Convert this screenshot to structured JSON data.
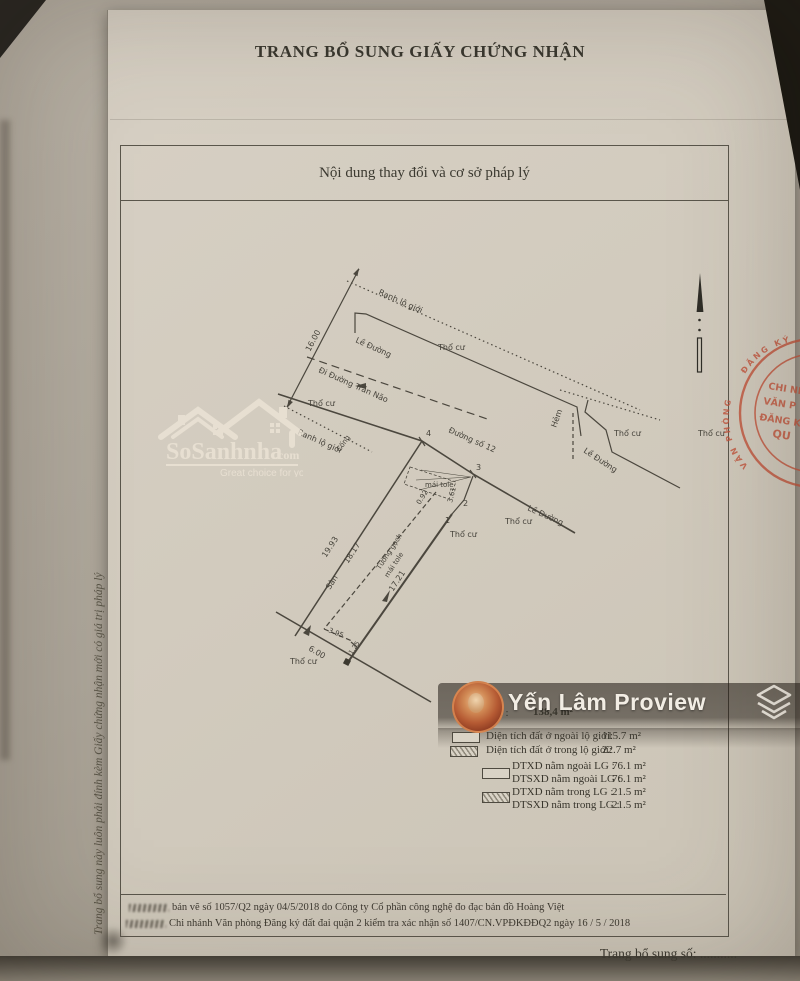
{
  "page": {
    "title": "TRANG BỔ SUNG GIẤY CHỨNG NHẬN",
    "box_header": "Nội dung thay đổi và cơ sở pháp lý",
    "side_note": "Trang bổ sung này luôn phải đính kèm Giấy chứng nhận mới có giá trị pháp lý",
    "footer_label": "Trang bổ sung số: ..........."
  },
  "watermark": {
    "brand": "SoSanhnha",
    "brand_suffix": ".com",
    "tagline": "Great choice for you"
  },
  "overlay": {
    "name": "Yến Lâm Proview"
  },
  "map": {
    "ranh_lo_gioi_1": "Ranh lộ giới",
    "ranh_lo_gioi_2": "Ranh lộ giới",
    "dim_16": "16.00",
    "le_duong_1": "Lề Đường",
    "le_duong_2": "Lề Đường",
    "le_duong_3": "Lề Đường",
    "di_duong_tran_nao": "Đi Đường Trần Não",
    "duong_so_12": "Đường số 12",
    "hem": "Hẻm",
    "cong": "Cống",
    "tho_cu_1": "Thổ cư",
    "tho_cu_2": "Thổ cư",
    "tho_cu_3": "Thổ cư",
    "tho_cu_4": "Thổ cư",
    "tho_cu_5": "Thổ cư",
    "tho_cu_6": "Thổ cư",
    "tho_cu_7": "Thổ cư",
    "mai_tole_shed": "mái tole",
    "tuong_gach_line1": "Tường gạch",
    "tuong_gach_line2": "mái tole",
    "san": "Sân",
    "dim_1993": "19.93",
    "dim_1817": "18.17",
    "dim_1721": "17.21",
    "dim_395": "3.95",
    "dim_600": "6.00",
    "dim_092": "0.92",
    "dim_361": "3.61",
    "dim_125": "1.25",
    "pt_1": "1",
    "pt_2": "2",
    "pt_3": "3",
    "pt_4": "4"
  },
  "legend": {
    "area_label": "khu đất :",
    "area_value": "138,4 m²",
    "rows": [
      {
        "label": "Diện tích đất ở ngoài lộ giới:",
        "value": "115.7 m²"
      },
      {
        "label": "Diện tích đất ở trong lộ giới:",
        "value": "22.7 m²"
      }
    ],
    "dt_rows": [
      {
        "label": "DTXD nằm ngoài LG :",
        "value": "76.1 m²"
      },
      {
        "label": "DTSXD nằm ngoài LG :",
        "value": "76.1 m²"
      },
      {
        "label": "DTXD nằm trong LG :",
        "value": "21.5 m²"
      },
      {
        "label": "DTSXD nằm trong LG :",
        "value": "21.5 m²"
      }
    ]
  },
  "verification": {
    "line1": "bản vẽ số 1057/Q2 ngày 04/5/2018 do Công ty Cổ phần công nghệ đo đạc bản đồ Hoàng Việt",
    "line2": "Chi nhánh Văn phòng Đăng ký đất đai quận 2 kiểm tra xác nhận số 1407/CN.VPĐKĐĐQ2 ngày 16 / 5 / 2018"
  },
  "stamp": {
    "arc_top": "ĐĂNG KÝ",
    "arc_left": "VĂN PHÒNG",
    "line1": "CHI NH",
    "line2": "VĂN P",
    "line3": "ĐĂNG K",
    "line4": "QU"
  },
  "colors": {
    "stamp_red": "#c2523a",
    "paper": "#d2cbbe",
    "ink": "#4b473e"
  }
}
